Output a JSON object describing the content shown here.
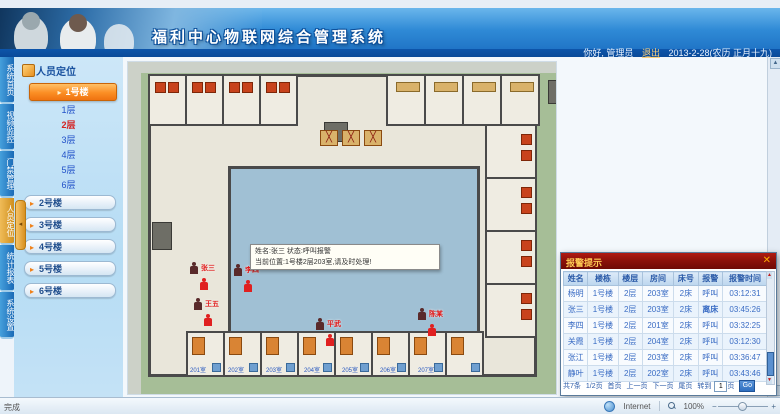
{
  "header": {
    "title": "福利中心物联网综合管理系统",
    "greeting": "你好, 管理员",
    "logout": "退出",
    "date": "2013-2-28(农历 正月十九)"
  },
  "nav_tabs": {
    "items": [
      "系统首页",
      "视频监控",
      "门禁管理",
      "人员定位",
      "统计报表",
      "系统设置"
    ],
    "active_index": 3
  },
  "sidebar": {
    "panel_title": "人员定位",
    "active_building": "1号楼",
    "floors": [
      "1层",
      "2层",
      "3层",
      "4层",
      "5层",
      "6层"
    ],
    "active_floor": "2层",
    "buildings": [
      "2号楼",
      "3号楼",
      "4号楼",
      "5号楼",
      "6号楼"
    ]
  },
  "floorplan": {
    "room_labels": [
      "201室",
      "202室",
      "203室",
      "204室",
      "205室",
      "206室",
      "207室"
    ],
    "tooltip": {
      "line1": "姓名:张三  状态:呼叫报警",
      "line2": "当前位置:1号楼2层203室,请及时处理!"
    },
    "markers": [
      {
        "name": "张三",
        "x": 62,
        "y": 200
      },
      {
        "name": "李四",
        "x": 106,
        "y": 202
      },
      {
        "name": "王五",
        "x": 66,
        "y": 236
      },
      {
        "name": "平武",
        "x": 188,
        "y": 256
      },
      {
        "name": "陈某",
        "x": 290,
        "y": 246
      }
    ]
  },
  "popup": {
    "title": "报警提示",
    "close_label": "✕",
    "columns": [
      "姓名",
      "楼栋",
      "楼层",
      "房间",
      "床号",
      "报警",
      "报警时间"
    ],
    "rows": [
      [
        "杨明",
        "1号楼",
        "2层",
        "203室",
        "2床",
        "呼叫",
        "03:12:31"
      ],
      [
        "张三",
        "1号楼",
        "2层",
        "203室",
        "2床",
        "离床",
        "03:45:26"
      ],
      [
        "李四",
        "1号楼",
        "2层",
        "201室",
        "2床",
        "呼叫",
        "03:32:25"
      ],
      [
        "关霞",
        "1号楼",
        "2层",
        "204室",
        "2床",
        "呼叫",
        "03:12:30"
      ],
      [
        "张江",
        "1号楼",
        "2层",
        "203室",
        "2床",
        "呼叫",
        "03:36:47"
      ],
      [
        "静叶",
        "1号楼",
        "2层",
        "202室",
        "2床",
        "呼叫",
        "03:43:46"
      ]
    ],
    "red_alarm_value": "离床",
    "pagination": {
      "total": "共7条",
      "page_info": "1/2页",
      "first": "首页",
      "prev": "上一页",
      "next": "下一页",
      "last": "尾页",
      "jump_label": "转到",
      "jump_value": "1",
      "page_unit": "页",
      "go": "Go"
    }
  },
  "statusbar": {
    "left": "完成",
    "zone": "Internet",
    "zoom": "100%"
  },
  "colors": {
    "header_blue": "#1a6cc0",
    "active_tab_orange": "#e8a43a",
    "building1_button_orange": "#fb8e24",
    "active_floor_red": "#d42222",
    "popup_title_red": "#8a100a",
    "alarm_text_red": "#d40000",
    "table_text_blue": "#3a6cc4",
    "courtyard_blue": "#a0c0d4",
    "lawn_green": "#a6be97"
  }
}
